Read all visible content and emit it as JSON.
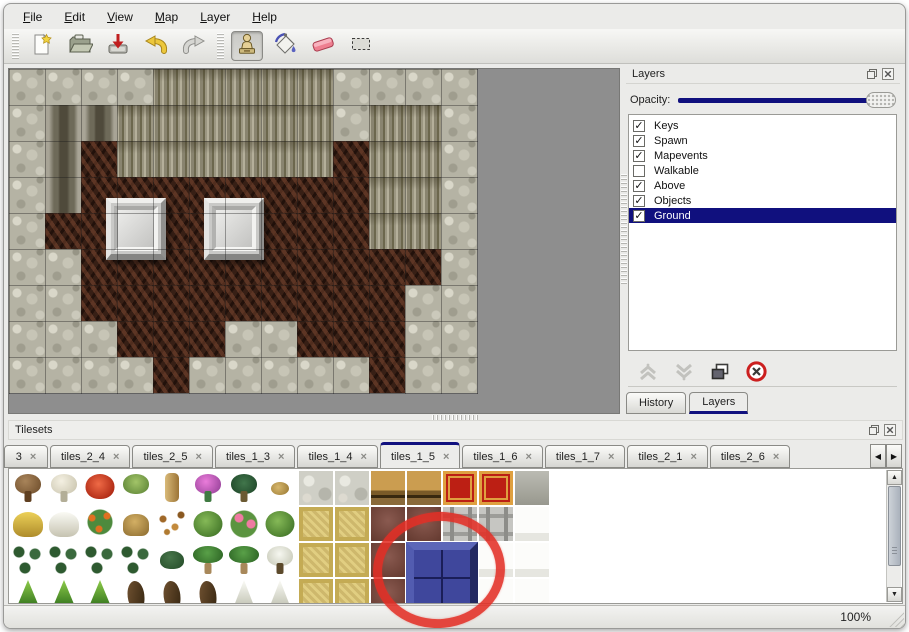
{
  "menu": {
    "items": [
      "File",
      "Edit",
      "View",
      "Map",
      "Layer",
      "Help"
    ]
  },
  "toolbar": {
    "tools": [
      {
        "name": "new",
        "icon": "new-file-icon",
        "active": false
      },
      {
        "name": "open",
        "icon": "open-file-icon",
        "active": false
      },
      {
        "name": "save",
        "icon": "save-icon",
        "active": false
      },
      {
        "name": "undo",
        "icon": "undo-icon",
        "active": false
      },
      {
        "name": "redo",
        "icon": "redo-icon",
        "active": false
      },
      {
        "name": "stamp",
        "icon": "stamp-tool-icon",
        "active": true
      },
      {
        "name": "fill",
        "icon": "fill-bucket-icon",
        "active": false
      },
      {
        "name": "eraser",
        "icon": "eraser-icon",
        "active": false
      },
      {
        "name": "select",
        "icon": "select-rect-icon",
        "active": false
      }
    ]
  },
  "layers_panel": {
    "title": "Layers",
    "title_icons": [
      "float-panel-icon",
      "close-panel-icon"
    ],
    "opacity_label": "Opacity:",
    "opacity_percent": 100,
    "layers": [
      {
        "name": "Keys",
        "checked": true,
        "selected": false
      },
      {
        "name": "Spawn",
        "checked": true,
        "selected": false
      },
      {
        "name": "Mapevents",
        "checked": true,
        "selected": false
      },
      {
        "name": "Walkable",
        "checked": false,
        "selected": false
      },
      {
        "name": "Above",
        "checked": true,
        "selected": false
      },
      {
        "name": "Objects",
        "checked": true,
        "selected": false
      },
      {
        "name": "Ground",
        "checked": true,
        "selected": true
      }
    ],
    "buttons": [
      {
        "name": "move-layer-up",
        "icon": "chevron-up-icon",
        "enabled": false
      },
      {
        "name": "move-layer-down",
        "icon": "chevron-down-icon",
        "enabled": false
      },
      {
        "name": "duplicate-layer",
        "icon": "copy-layers-icon",
        "enabled": true
      },
      {
        "name": "delete-layer",
        "icon": "delete-icon",
        "enabled": true
      }
    ],
    "tabs": [
      {
        "label": "History",
        "active": false
      },
      {
        "label": "Layers",
        "active": true
      }
    ]
  },
  "tilesets_panel": {
    "title": "Tilesets",
    "title_icons": [
      "float-panel-icon",
      "close-panel-icon"
    ],
    "tab_close_icon": "close-tab-icon",
    "tabs": [
      {
        "label": "3",
        "active": false
      },
      {
        "label": "tiles_2_4",
        "active": false
      },
      {
        "label": "tiles_2_5",
        "active": false
      },
      {
        "label": "tiles_1_3",
        "active": false
      },
      {
        "label": "tiles_1_4",
        "active": false
      },
      {
        "label": "tiles_1_5",
        "active": true
      },
      {
        "label": "tiles_1_6",
        "active": false
      },
      {
        "label": "tiles_1_7",
        "active": false
      },
      {
        "label": "tiles_2_1",
        "active": false
      },
      {
        "label": "tiles_2_6",
        "active": false
      }
    ],
    "scroll_icons": [
      "scroll-left-icon",
      "scroll-right-icon"
    ],
    "palette_rows": [
      [
        "dead-tree",
        "white-tree",
        "red-flower",
        "stump",
        "trunk",
        "pink-bush",
        "dark-palm",
        "sprout",
        "stone-floor",
        "stone-floor",
        "wood-counter",
        "wood-counter",
        "red-carpet",
        "red-carpet",
        "gray-stone"
      ],
      [
        "hay-mound",
        "snow-mound",
        "orange-flowers",
        "dry-grass",
        "leaves",
        "lily-pad",
        "pink-lily",
        "lily-pad",
        "tan-carpet",
        "tan-carpet",
        "leather",
        "leather",
        "metal-frame",
        "metal-frame",
        "white-tile"
      ],
      [
        "bushes",
        "bushes",
        "bushes",
        "bushes",
        "bush",
        "palm",
        "palm",
        "snow-palm",
        "tan-carpet",
        "tan-carpet",
        "leather",
        "blue-selected",
        "blue-selected",
        "white-tile",
        "white-tile"
      ],
      [
        "cone-tree",
        "cone-tree",
        "cone-tree",
        "twisted-trunk",
        "twisted-trunk",
        "twisted-trunk",
        "snow-tree",
        "snow-tree",
        "tan-carpet",
        "tan-carpet",
        "leather",
        "blue-selected",
        "blue-selected",
        "white-tile",
        "white-tile"
      ]
    ],
    "selected_tile": {
      "row": 2,
      "col": 11,
      "rowspan": 2,
      "colspan": 2,
      "type": "blue-selected"
    },
    "annotation": {
      "shape": "red-circle",
      "color": "#e22f26"
    }
  },
  "map": {
    "tile_size": 36,
    "legend": {
      "R": "rock",
      "C": "crevice",
      "W": "wall-face",
      "F": "floor"
    },
    "grid": [
      "RRRRWWWWWRRRR",
      "RCCWWWWWWRWWR",
      "RCFWWWWWWFWWR",
      "RCFFFFFFFFWWR",
      "RFFFFFFFFFWWR",
      "RRFFFFFFFFFFR",
      "RRFFFFFFFFFRR",
      "RRRFFFRRFFFRR",
      "RRRRFRRRRRFRR"
    ],
    "pedestals": [
      {
        "x": 97,
        "y": 129
      },
      {
        "x": 195,
        "y": 129
      }
    ]
  },
  "status": {
    "zoom_level": "100%"
  }
}
